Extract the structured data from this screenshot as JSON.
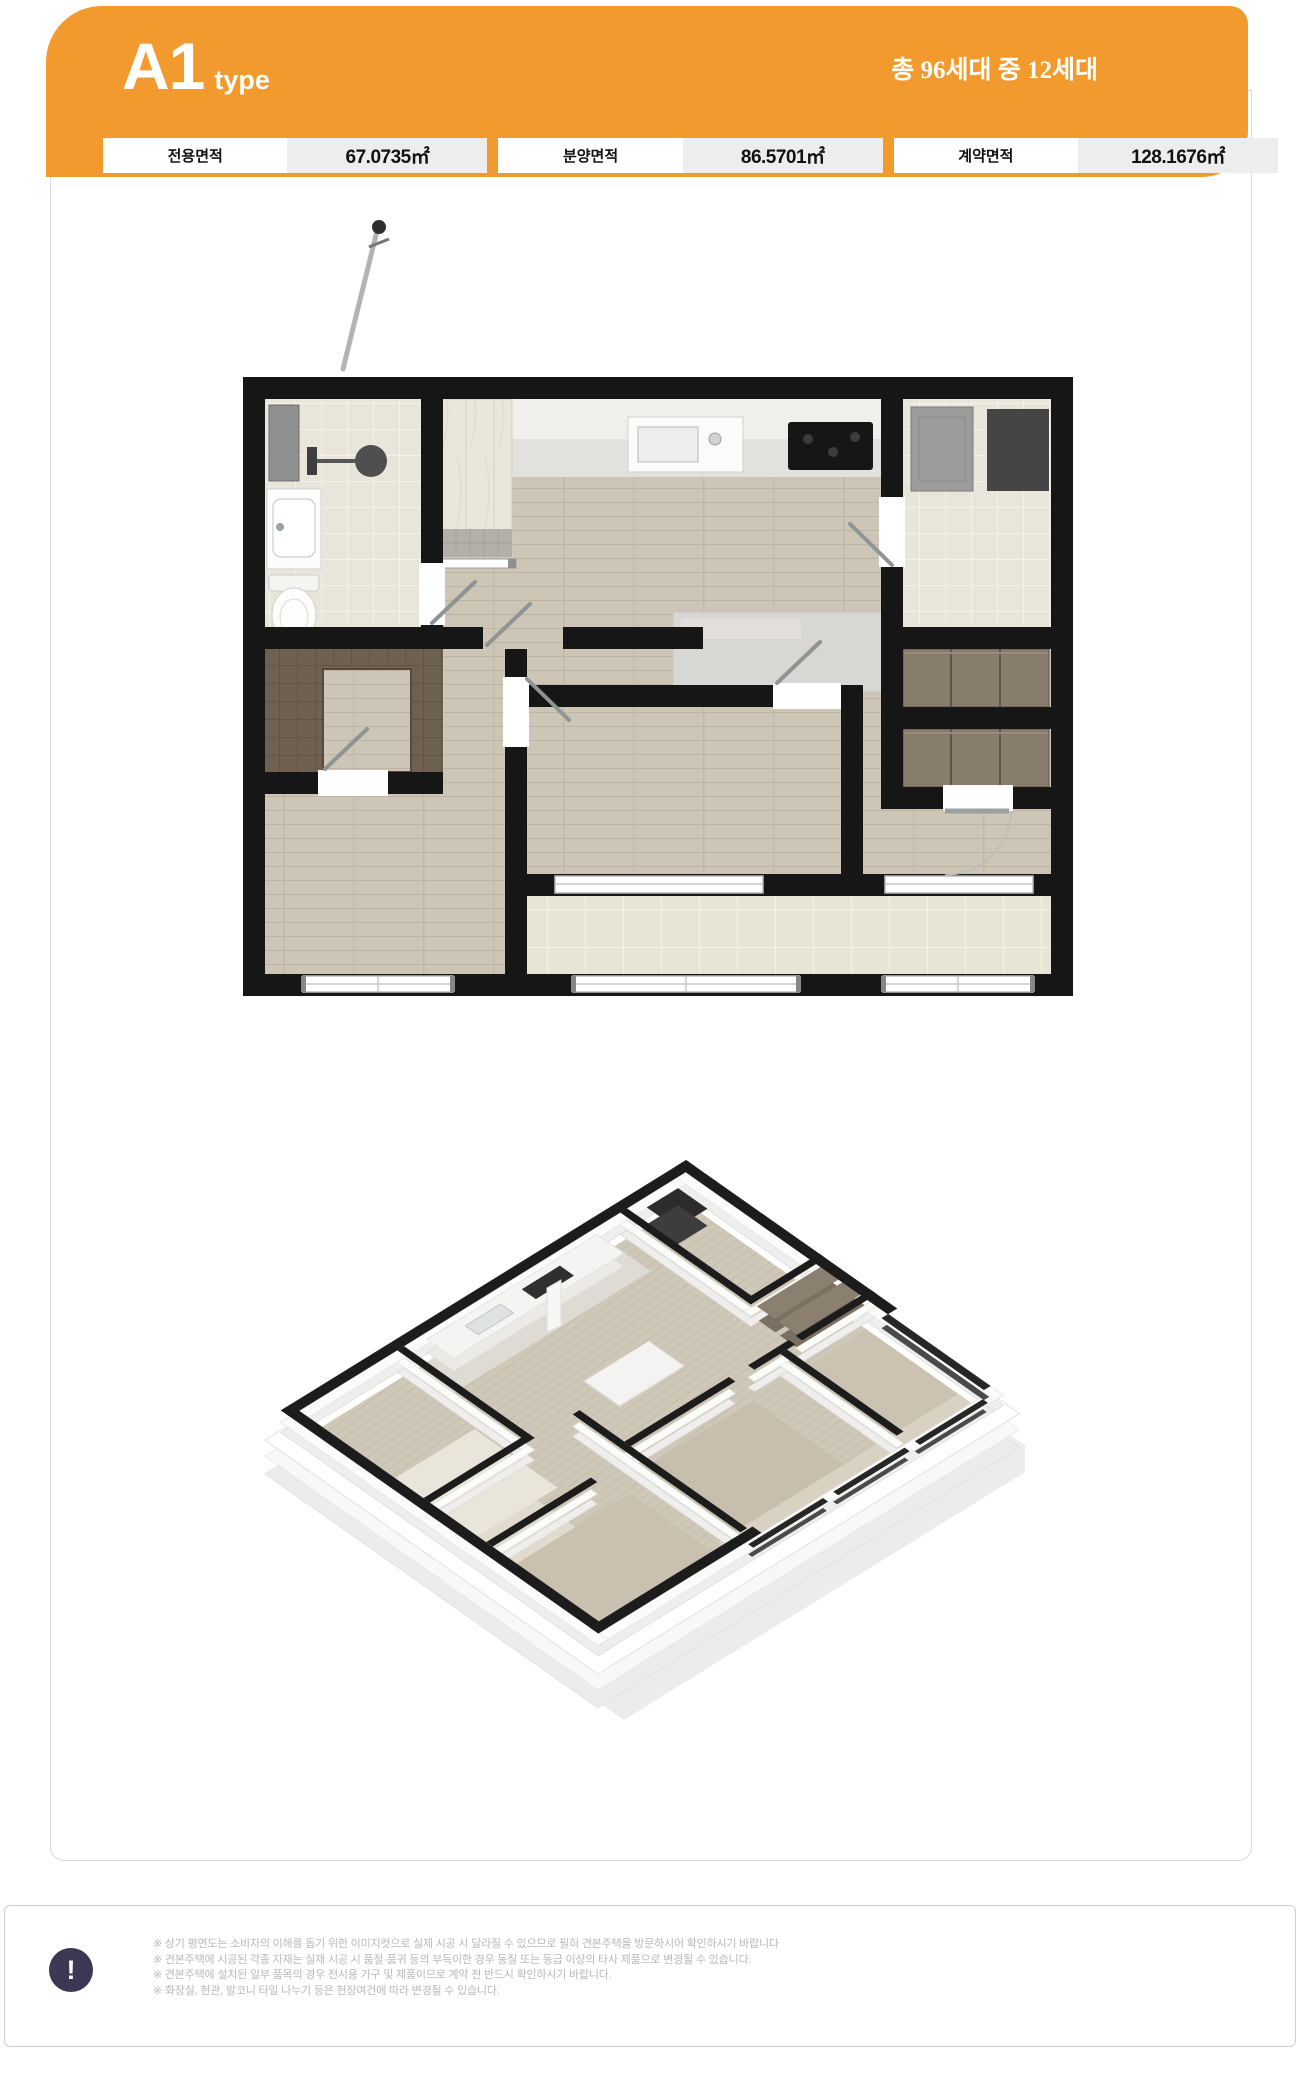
{
  "header": {
    "type_code": "A1",
    "type_suffix": "type",
    "units_label": "총 96세대 중 12세대",
    "accent_color": "#F29A2E"
  },
  "areas": [
    {
      "label": "전용면적",
      "value": "67.0735㎡"
    },
    {
      "label": "분양면적",
      "value": "86.5701㎡"
    },
    {
      "label": "계약면적",
      "value": "128.1676㎡"
    }
  ],
  "plans": {
    "plan_2d": "2D floor plan render",
    "plan_3d": "3D isometric floor plan render",
    "wall_color": "#161616",
    "wood_color": "#cdc5b6",
    "tile_color": "#e9e5db"
  },
  "footer": {
    "icon_glyph": "!",
    "icon_color": "#3A3852",
    "notes": [
      "※ 상기 평면도는 소비자의 이해를 돕기 위한 이미지컷으로 실제 시공 시 달라질 수 있으므로 필히 견본주택을 방문하시어 확인하시기 바랍니다",
      "※ 견본주택에 시공된 각종 자재는 실제 시공 시 품절·품귀 등의 부득이한 경우 동질 또는 동급 이상의 타사 제품으로 변경될 수 있습니다.",
      "※ 견본주택에 설치된 일부 품목의 경우 전시용 가구 및 제품이므로 계약 전 반드시 확인하시기 바랍니다.",
      "※ 화장실, 현관, 발코니 타일 나누기 등은 현장여건에 따라 변경될 수 있습니다."
    ]
  }
}
